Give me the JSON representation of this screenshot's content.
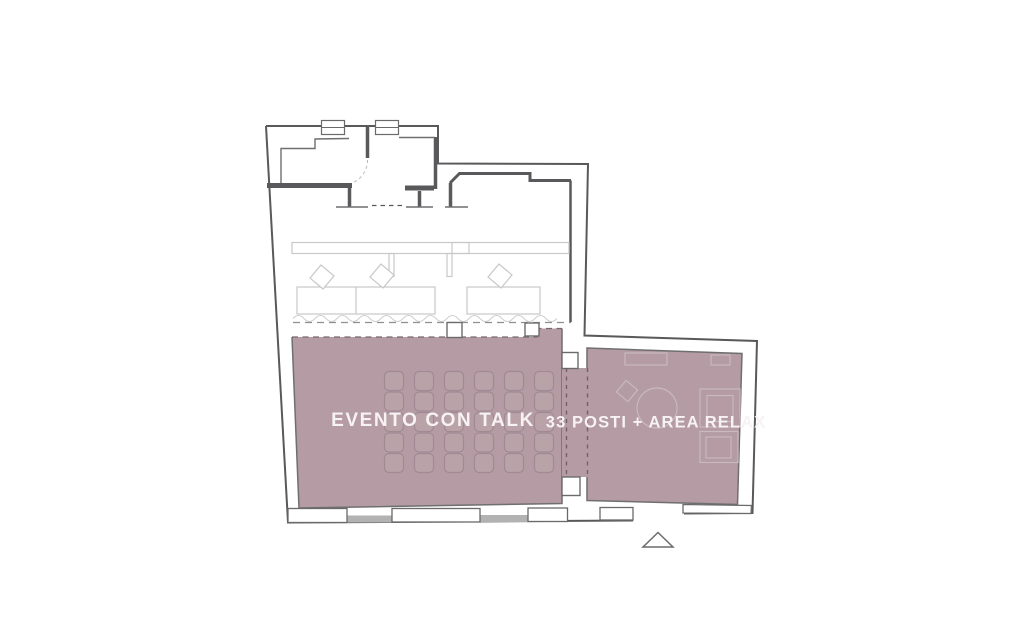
{
  "floor_plan": {
    "zones": [
      {
        "id": "evento-con-talk",
        "label": "EVENTO CON TALK",
        "color": "#b59ba3",
        "text_color": "#f7f2f4"
      },
      {
        "id": "area-relax",
        "label": "33 POSTI + AREA RELAX",
        "color": "#b59ba3",
        "text_color": "#f7f2f4"
      }
    ],
    "seating": {
      "rows": 5,
      "columns": 6
    },
    "markers": [
      {
        "id": "entrance",
        "shape": "triangle"
      }
    ],
    "colors": {
      "wall": "#59595b",
      "wall_light": "#6f6f71",
      "furniture": "#c8c8c8",
      "ghost_furniture": "#c9b9c0",
      "window_glass": "#b2b2b2",
      "highlight": "#b59ba3",
      "seat_outline": "#a18a94",
      "label_text": "#f7f2f4"
    }
  }
}
